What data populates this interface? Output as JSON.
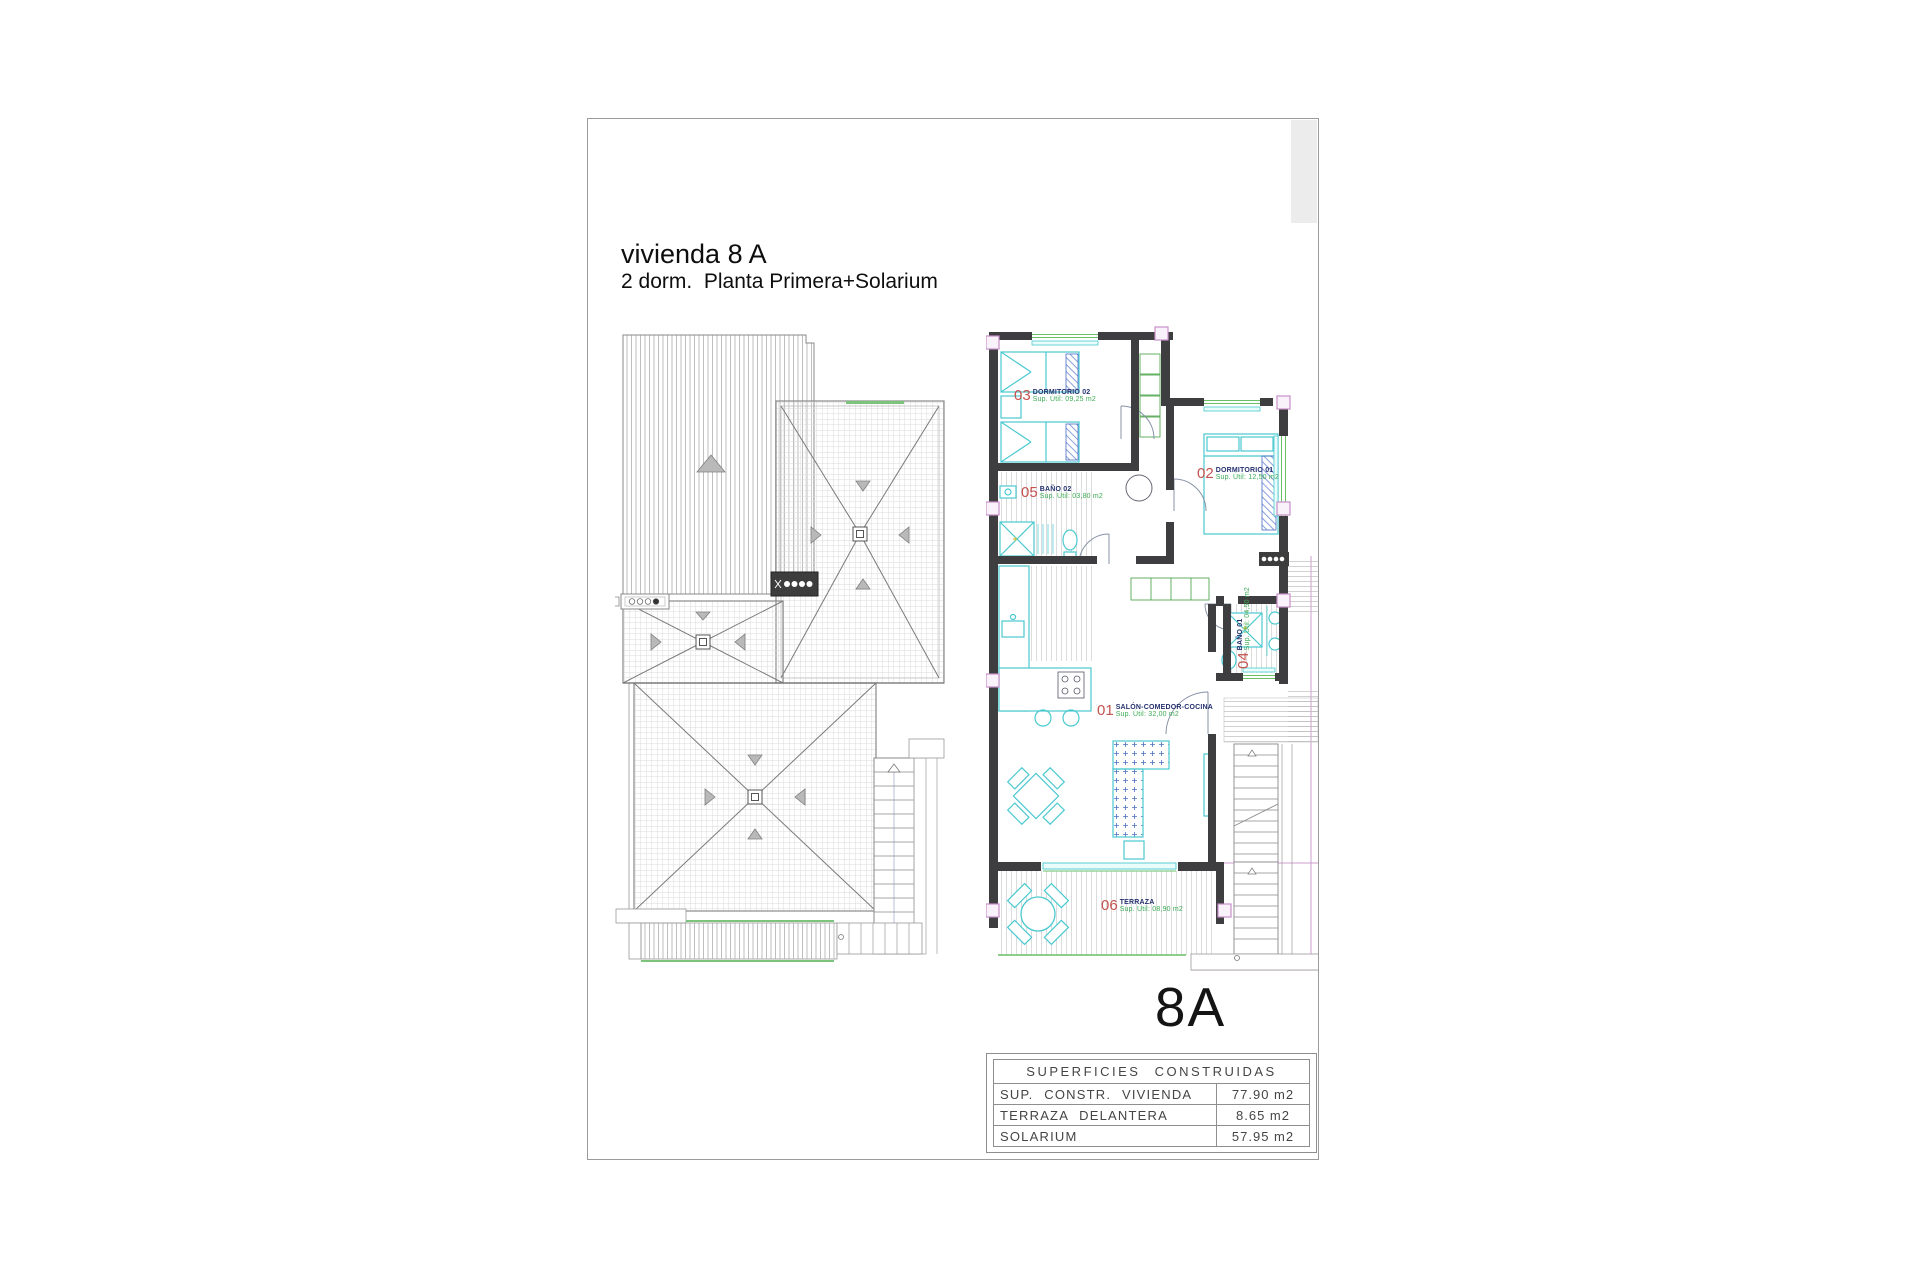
{
  "sheet": {
    "title": {
      "line1": "vivienda 8 A",
      "line2": "2 dorm.  Planta Primera+Solarium"
    },
    "unit_label": "8A",
    "rooms": [
      {
        "number": "01",
        "name": "SALÓN-COMEDOR-COCINA",
        "area": "Sup. Útil: 32,00 m2"
      },
      {
        "number": "02",
        "name": "DORMITORIO 01",
        "area": "Sup. Útil: 12,50 m2"
      },
      {
        "number": "03",
        "name": "DORMITORIO 02",
        "area": "Sup. Útil: 09,25 m2"
      },
      {
        "number": "04",
        "name": "BAÑO 01",
        "area": "Sup. Útil: 04,50 m2"
      },
      {
        "number": "05",
        "name": "BAÑO 02",
        "area": "Sup. Útil: 03,80 m2"
      },
      {
        "number": "06",
        "name": "TERRAZA",
        "area": "Sup. Útil: 08,90 m2"
      }
    ],
    "areas_table": {
      "header": "SUPERFICIES CONSTRUIDAS",
      "rows": [
        {
          "label": "SUP. CONSTR. VIVIENDA",
          "value": "77.90 m2"
        },
        {
          "label": "TERRAZA DELANTERA",
          "value": "8.65 m2"
        },
        {
          "label": "SOLARIUM",
          "value": "57.95 m2"
        }
      ]
    },
    "colors": {
      "wall": "#3e3e40",
      "furniture_cyan": "#49c9cf",
      "window_green": "#6abf69",
      "label_number_red": "#c4524e",
      "label_name_navy": "#25316e",
      "label_area_green": "#3cab54",
      "pillar_pink": "#c78fc7",
      "boundary_magenta": "#cc9ccc"
    }
  }
}
